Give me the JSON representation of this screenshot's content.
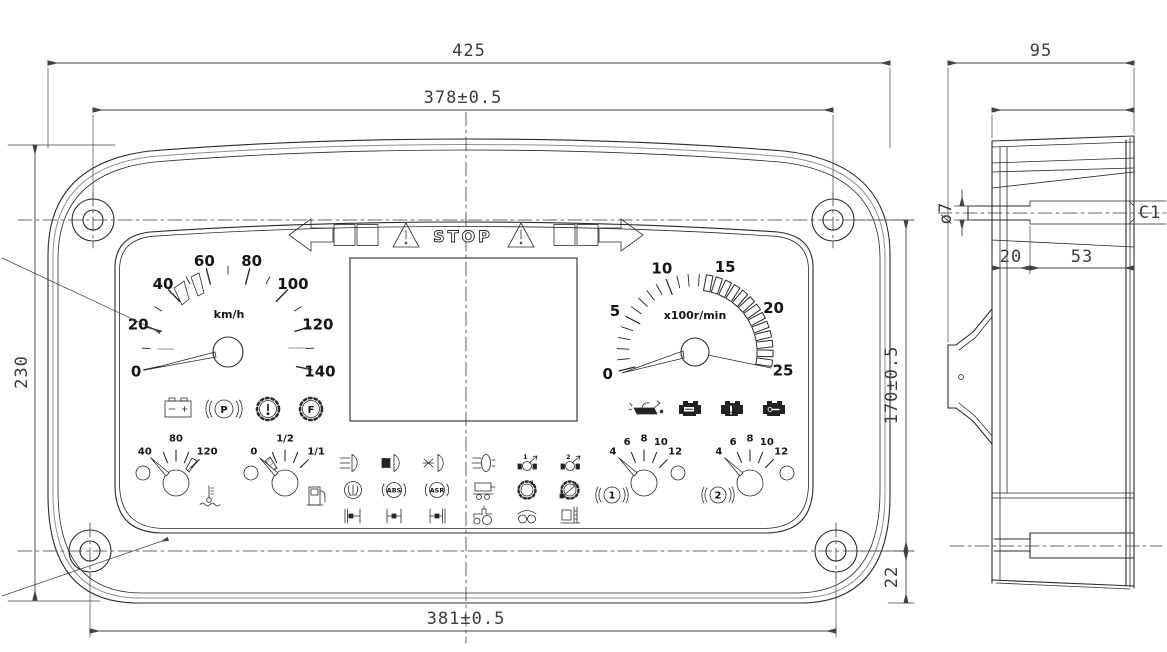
{
  "drawing": {
    "dimensions": {
      "overall_width": "425",
      "mount_width_top": "378±0.5",
      "overall_height": "230",
      "mount_height": "170±0.5",
      "mount_width_bottom": "381±0.5",
      "bottom_offset": "22",
      "side_depth_overall": "95",
      "side_depth_body": "72,6",
      "stud_diameter": "ø7",
      "stud_inset": "20",
      "slot_length": "53",
      "chamfer": "C1"
    },
    "cluster": {
      "telltale_bar": {
        "stop": "STOP"
      },
      "speedometer": {
        "unit": "km/h",
        "scale": [
          "0",
          "20",
          "40",
          "60",
          "80",
          "100",
          "120",
          "140"
        ]
      },
      "tachometer": {
        "unit": "x100r/min",
        "scale": [
          "0",
          "5",
          "10",
          "15",
          "20",
          "25"
        ]
      },
      "temperature_gauge": {
        "scale": [
          "40",
          "80",
          "120"
        ]
      },
      "fuel_gauge": {
        "scale": [
          "0",
          "1/2",
          "1/1"
        ]
      },
      "pressure_gauge_1": {
        "scale": [
          "4",
          "6",
          "8",
          "10",
          "12"
        ],
        "badge": "1"
      },
      "pressure_gauge_2": {
        "scale": [
          "4",
          "6",
          "8",
          "10",
          "12"
        ],
        "badge": "2"
      },
      "telltale_letters": {
        "parking": "P",
        "gear_f": "F",
        "abs": "ABS",
        "asr": "ASR",
        "low_range": "L",
        "pto1": "1",
        "pto2": "2"
      },
      "warning_lamps_left": [
        "battery",
        "parking-brake",
        "brake-fault",
        "gear-fault"
      ],
      "warning_lamps_right": [
        "oil-pressure",
        "engine-stop",
        "engine-warning",
        "engine-service"
      ],
      "telltale_grid": [
        [
          "high-beam",
          "low-beam",
          "front-fog",
          "rear-fog",
          "pto-1",
          "pto-2"
        ],
        [
          "fan",
          "abs",
          "asr",
          "trailer",
          "low-range",
          "gear-shift"
        ],
        [
          "front-diff-lock",
          "center-diff-lock",
          "rear-diff-lock",
          "tractor",
          "tow-hook",
          "loader"
        ]
      ]
    }
  }
}
